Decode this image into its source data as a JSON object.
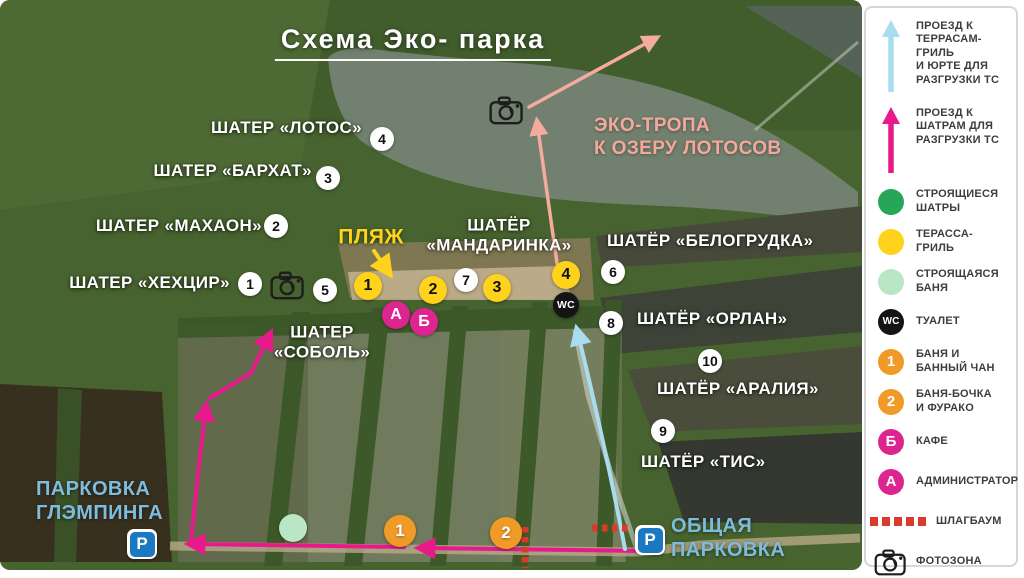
{
  "title": {
    "text": "Схема Эко- парка"
  },
  "colors": {
    "magenta": "#dd2590",
    "magenta_arrow": "#e8198b",
    "salmon": "#f5ab9e",
    "light_blue_arrow": "#a9dcee",
    "yellow": "#ffd21c",
    "orange": "#f09a27",
    "green": "#27a658",
    "light_green": "#b9e6c4",
    "red_barrier": "#d93a2b",
    "parking_blue": "#1a79c0",
    "label_blue": "#7fbbdc",
    "label_salmon": "#f4a89c"
  },
  "map": {
    "labels": [
      {
        "name": "label-shater-lotos",
        "lines": [
          "ШАТЕР «ЛОТОС»"
        ],
        "x": 362,
        "y": 128,
        "anchor": "right",
        "style": "white",
        "size": 17
      },
      {
        "name": "label-shater-barhat",
        "lines": [
          "ШАТЕР «БАРХАТ»"
        ],
        "x": 312,
        "y": 171,
        "anchor": "right",
        "style": "white",
        "size": 17
      },
      {
        "name": "label-shater-mahaon",
        "lines": [
          "ШАТЕР «МАХАОН»"
        ],
        "x": 262,
        "y": 226,
        "anchor": "right",
        "style": "white",
        "size": 17
      },
      {
        "name": "label-shater-hehcir",
        "lines": [
          "ШАТЕР «ХЕХЦИР»"
        ],
        "x": 230,
        "y": 283,
        "anchor": "right",
        "style": "white",
        "size": 17
      },
      {
        "name": "label-shater-sobol",
        "lines": [
          "ШАТЕР",
          "«СОБОЛЬ»"
        ],
        "x": 322,
        "y": 343,
        "anchor": "center",
        "style": "white",
        "size": 17
      },
      {
        "name": "label-shater-mandarinka",
        "lines": [
          "ШАТЁР",
          "«МАНДАРИНКА»"
        ],
        "x": 499,
        "y": 236,
        "anchor": "center",
        "style": "white",
        "size": 17
      },
      {
        "name": "label-shater-belogrudka",
        "lines": [
          "ШАТЁР «БЕЛОГРУДКА»"
        ],
        "x": 607,
        "y": 241,
        "anchor": "left",
        "style": "white",
        "size": 17
      },
      {
        "name": "label-shater-orlan",
        "lines": [
          "ШАТЁР «ОРЛАН»"
        ],
        "x": 637,
        "y": 319,
        "anchor": "left",
        "style": "white",
        "size": 17
      },
      {
        "name": "label-shater-aralia",
        "lines": [
          "ШАТЁР «АРАЛИЯ»"
        ],
        "x": 657,
        "y": 389,
        "anchor": "left",
        "style": "white",
        "size": 17
      },
      {
        "name": "label-shater-tis",
        "lines": [
          "ШАТЁР «ТИС»"
        ],
        "x": 641,
        "y": 462,
        "anchor": "left",
        "style": "white",
        "size": 17
      },
      {
        "name": "label-beach",
        "lines": [
          "ПЛЯЖ"
        ],
        "x": 371,
        "y": 237,
        "anchor": "center",
        "style": "yellow",
        "size": 21
      },
      {
        "name": "label-eco-trail",
        "lines": [
          "ЭКО-ТРОПА",
          "К ОЗЕРУ ЛОТОСОВ"
        ],
        "x": 594,
        "y": 138,
        "anchor": "left",
        "style": "salmon",
        "size": 19
      },
      {
        "name": "label-parking-glamping",
        "lines": [
          "ПАРКОВКА",
          "ГЛЭМПИНГА"
        ],
        "x": 36,
        "y": 501,
        "anchor": "left",
        "style": "blue",
        "size": 20
      },
      {
        "name": "label-parking-common",
        "lines": [
          "ОБЩАЯ",
          "ПАРКОВКА"
        ],
        "x": 671,
        "y": 538,
        "anchor": "left",
        "style": "blue",
        "size": 20
      }
    ],
    "markers": [
      {
        "name": "marker-tent-1",
        "type": "white",
        "label": "1",
        "x": 250,
        "y": 284
      },
      {
        "name": "marker-tent-2",
        "type": "white",
        "label": "2",
        "x": 276,
        "y": 226
      },
      {
        "name": "marker-tent-3",
        "type": "white",
        "label": "3",
        "x": 328,
        "y": 178
      },
      {
        "name": "marker-tent-4",
        "type": "white",
        "label": "4",
        "x": 382,
        "y": 139
      },
      {
        "name": "marker-tent-5",
        "type": "white",
        "label": "5",
        "x": 325,
        "y": 290
      },
      {
        "name": "marker-tent-6",
        "type": "white",
        "label": "6",
        "x": 613,
        "y": 272
      },
      {
        "name": "marker-tent-7",
        "type": "white",
        "label": "7",
        "x": 466,
        "y": 280
      },
      {
        "name": "marker-tent-8",
        "type": "white",
        "label": "8",
        "x": 611,
        "y": 323
      },
      {
        "name": "marker-tent-9",
        "type": "white",
        "label": "9",
        "x": 663,
        "y": 431
      },
      {
        "name": "marker-tent-10",
        "type": "white",
        "label": "10",
        "x": 710,
        "y": 361
      },
      {
        "name": "marker-terrace-1",
        "type": "yellow",
        "label": "1",
        "x": 368,
        "y": 286
      },
      {
        "name": "marker-terrace-2",
        "type": "yellow",
        "label": "2",
        "x": 433,
        "y": 290
      },
      {
        "name": "marker-terrace-3",
        "type": "yellow",
        "label": "3",
        "x": 497,
        "y": 288
      },
      {
        "name": "marker-terrace-4",
        "type": "yellow",
        "label": "4",
        "x": 566,
        "y": 275
      },
      {
        "name": "marker-admin",
        "type": "magenta",
        "label": "А",
        "x": 396,
        "y": 315
      },
      {
        "name": "marker-cafe",
        "type": "magenta",
        "label": "Б",
        "x": 424,
        "y": 322
      },
      {
        "name": "marker-wc",
        "type": "wc",
        "label": "WC",
        "x": 566,
        "y": 305
      },
      {
        "name": "marker-bath-1",
        "type": "orange",
        "label": "1",
        "x": 400,
        "y": 531
      },
      {
        "name": "marker-bath-2",
        "type": "orange",
        "label": "2",
        "x": 506,
        "y": 533
      },
      {
        "name": "marker-bath-construction",
        "type": "green",
        "label": "",
        "x": 293,
        "y": 528
      },
      {
        "name": "photo-zone-lake",
        "type": "photo",
        "label": "",
        "x": 507,
        "y": 110
      },
      {
        "name": "photo-zone-shore",
        "type": "photo",
        "label": "",
        "x": 288,
        "y": 285
      },
      {
        "name": "parking-glamping-icon",
        "type": "parking",
        "label": "P",
        "x": 142,
        "y": 544
      },
      {
        "name": "parking-common-icon",
        "type": "parking",
        "label": "P",
        "x": 650,
        "y": 540
      }
    ]
  },
  "legend": {
    "items": [
      {
        "name": "legend-drive-terraces",
        "icon": "arrow-blue",
        "label": "",
        "lines": [
          "ПРОЕЗД К",
          "ТЕРРАСАМ-ГРИЛЬ",
          "И ЮРТЕ ДЛЯ",
          "РАЗГРУЗКИ ТС"
        ]
      },
      {
        "name": "legend-drive-tents",
        "icon": "arrow-magenta",
        "label": "",
        "lines": [
          "ПРОЕЗД К",
          "ШАТРАМ ДЛЯ",
          "РАЗГРУЗКИ ТС"
        ]
      },
      {
        "name": "legend-tents-construction",
        "icon": "circle-green",
        "label": "",
        "lines": [
          "СТРОЯЩИЕСЯ",
          "ШАТРЫ"
        ]
      },
      {
        "name": "legend-terrace-grill",
        "icon": "circle-yellow",
        "label": "",
        "lines": [
          "ТЕРАССА-",
          "ГРИЛЬ"
        ]
      },
      {
        "name": "legend-bath-construction",
        "icon": "circle-lightgreen",
        "label": "",
        "lines": [
          "СТРОЯЩАЯСЯ",
          "БАНЯ"
        ]
      },
      {
        "name": "legend-wc",
        "icon": "circle-wc",
        "label": "WC",
        "lines": [
          "ТУАЛЕТ"
        ]
      },
      {
        "name": "legend-bath-chan",
        "icon": "circle-orange",
        "label": "1",
        "lines": [
          "БАНЯ И",
          "БАННЫЙ ЧАН"
        ]
      },
      {
        "name": "legend-bath-barrel",
        "icon": "circle-orange",
        "label": "2",
        "lines": [
          "БАНЯ-БОЧКА",
          "И ФУРАКО"
        ]
      },
      {
        "name": "legend-cafe",
        "icon": "circle-magenta",
        "label": "Б",
        "lines": [
          "КАФЕ"
        ]
      },
      {
        "name": "legend-admin",
        "icon": "circle-magenta",
        "label": "А",
        "lines": [
          "АДМИНИСТРАТОР"
        ]
      },
      {
        "name": "legend-barrier",
        "icon": "dashed-red",
        "label": "",
        "lines": [
          "ШЛАГБАУМ"
        ]
      },
      {
        "name": "legend-photo-zone",
        "icon": "camera",
        "label": "",
        "lines": [
          "ФОТОЗОНА"
        ]
      }
    ]
  }
}
